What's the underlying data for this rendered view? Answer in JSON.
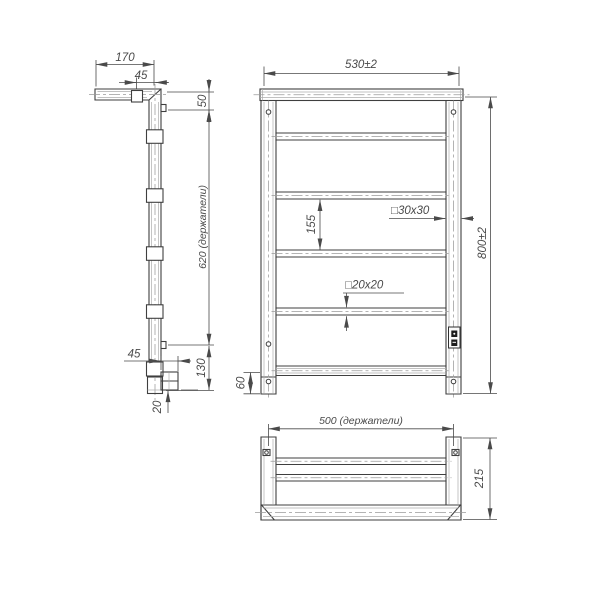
{
  "drawing": {
    "side_view": {
      "dim_depth": "170",
      "dim_top_holder": "45",
      "dim_top_bracket": "50",
      "dim_holders_span": "620 (держатели)",
      "dim_bottom_holder": "45",
      "dim_bottom_bracket": "130",
      "dim_foot": "20"
    },
    "front_view": {
      "dim_width": "530±2",
      "dim_rail_gap": "155",
      "label_frame_profile": "□30x30",
      "label_rail_profile": "□20x20",
      "dim_height": "800±2",
      "dim_bottom_gap": "60"
    },
    "top_view": {
      "dim_holders_span": "500 (держатели)",
      "dim_depth": "215"
    },
    "colors": {
      "line": "#3f3f3f",
      "dimension": "#4a4a4a",
      "centerline": "#9a9a9a",
      "background": "#ffffff"
    }
  }
}
